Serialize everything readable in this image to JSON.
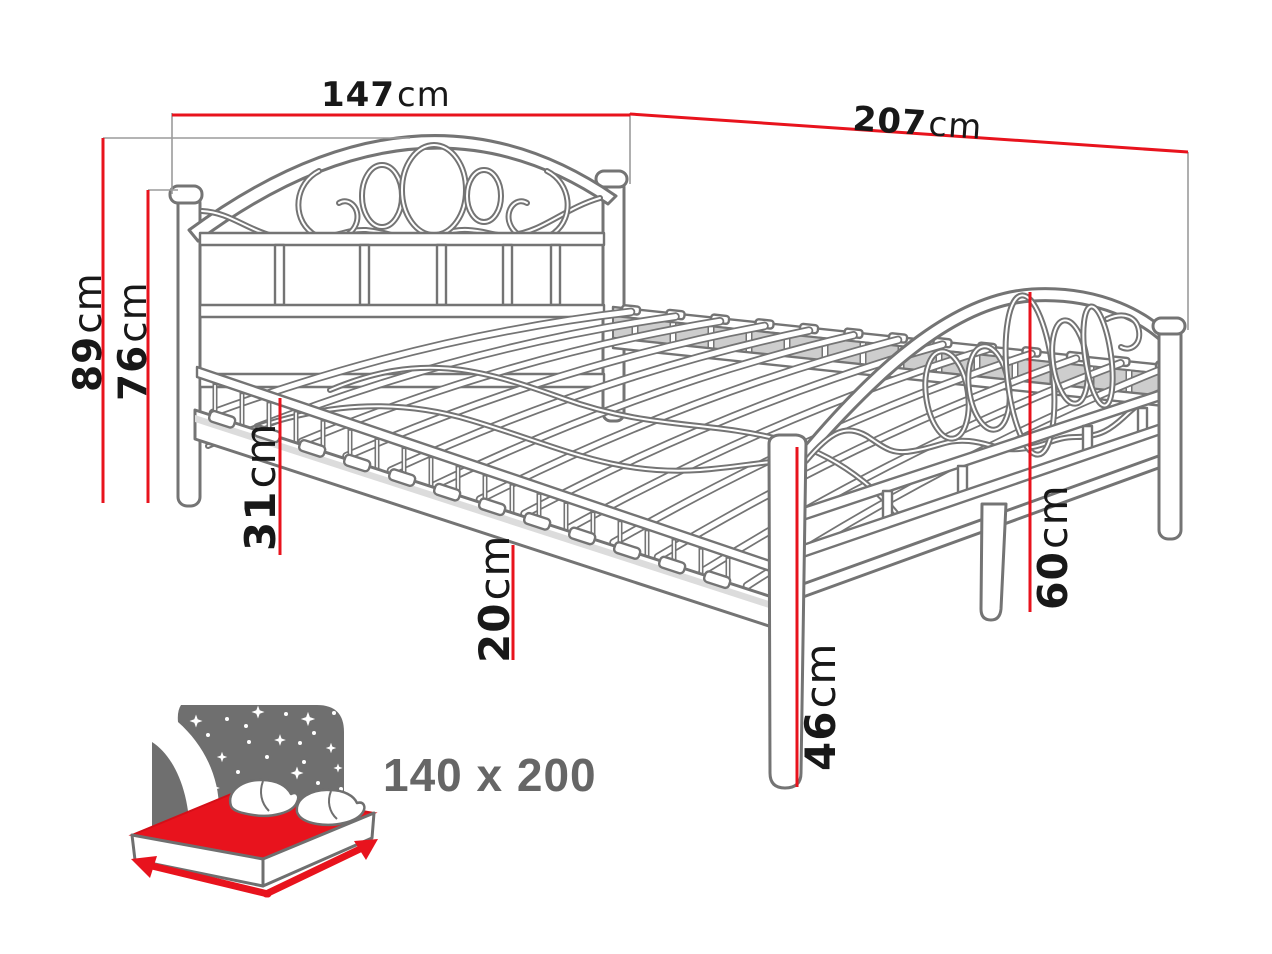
{
  "colors": {
    "background": "#ffffff",
    "dimension_red": "#e8131d",
    "line_gray": "#747474",
    "shade_gray": "#cdcdcd",
    "icon_gray": "#6f6f6f",
    "label_black": "#181818",
    "size_text_gray": "#666666"
  },
  "dims": {
    "w147": {
      "value": "147",
      "unit": "cm"
    },
    "l207": {
      "value": "207",
      "unit": "cm"
    },
    "h89": {
      "value": "89",
      "unit": "cm"
    },
    "h76": {
      "value": "76",
      "unit": "cm"
    },
    "h31": {
      "value": "31",
      "unit": "cm"
    },
    "h20": {
      "value": "20",
      "unit": "cm"
    },
    "h60": {
      "value": "60",
      "unit": "cm"
    },
    "h46": {
      "value": "46",
      "unit": "cm"
    }
  },
  "icon": {
    "size_label": "140 x 200"
  }
}
